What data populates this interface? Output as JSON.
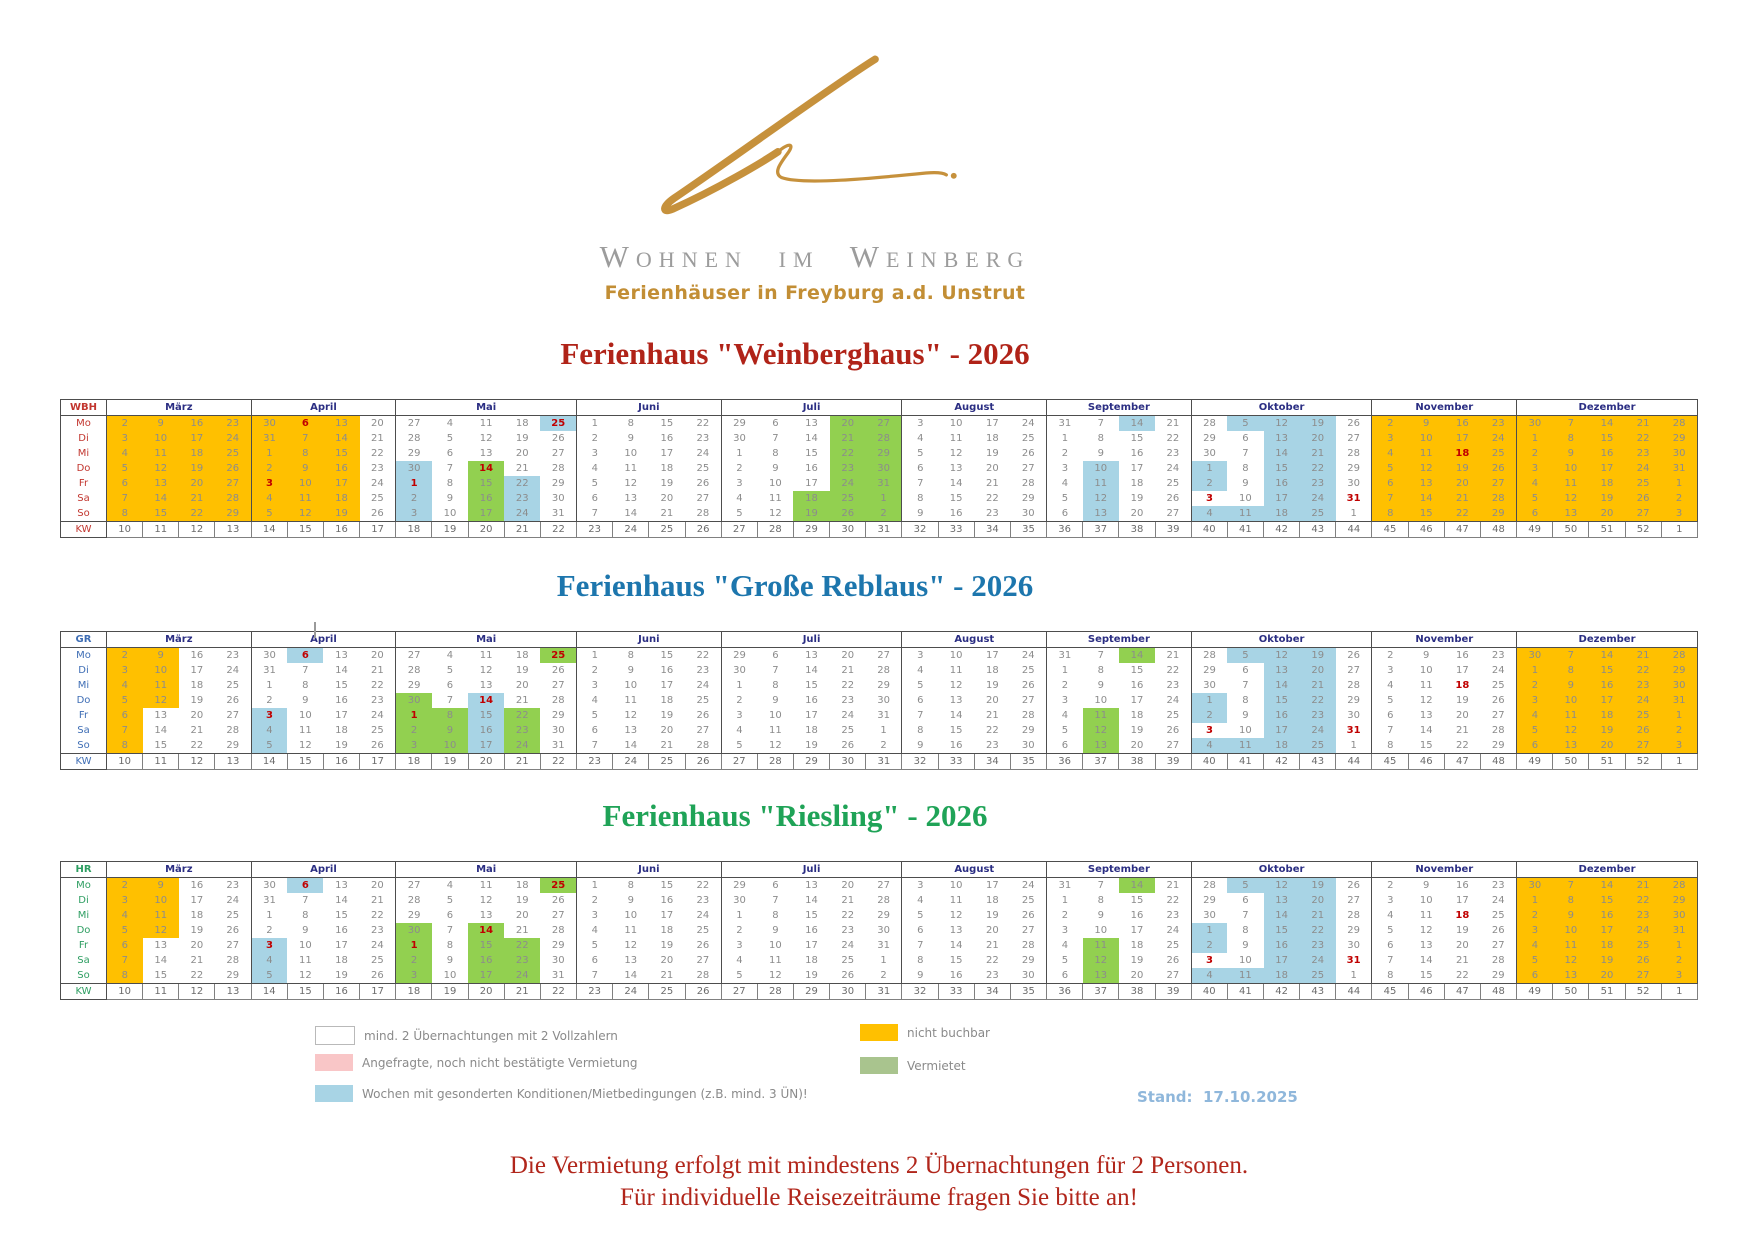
{
  "header": {
    "brand": "Wohnen im Weinberg",
    "subtitle": "Ferienhäuser in Freyburg a.d. Unstrut"
  },
  "day_labels": [
    "Mo",
    "Di",
    "Mi",
    "Do",
    "Fr",
    "Sa",
    "So"
  ],
  "kw_label": "KW",
  "months": [
    {
      "name": "März",
      "kw": [
        "10",
        "11",
        "12",
        "13"
      ],
      "days": [
        [
          "2",
          "9",
          "16",
          "23"
        ],
        [
          "3",
          "10",
          "17",
          "24"
        ],
        [
          "4",
          "11",
          "18",
          "25"
        ],
        [
          "5",
          "12",
          "19",
          "26"
        ],
        [
          "6",
          "13",
          "20",
          "27"
        ],
        [
          "7",
          "14",
          "21",
          "28"
        ],
        [
          "8",
          "15",
          "22",
          "29"
        ]
      ]
    },
    {
      "name": "April",
      "kw": [
        "14",
        "15",
        "16",
        "17"
      ],
      "days": [
        [
          "30",
          "6",
          "13",
          "20"
        ],
        [
          "31",
          "7",
          "14",
          "21"
        ],
        [
          "1",
          "8",
          "15",
          "22"
        ],
        [
          "2",
          "9",
          "16",
          "23"
        ],
        [
          "3",
          "10",
          "17",
          "24"
        ],
        [
          "4",
          "11",
          "18",
          "25"
        ],
        [
          "5",
          "12",
          "19",
          "26"
        ]
      ]
    },
    {
      "name": "Mai",
      "kw": [
        "18",
        "19",
        "20",
        "21",
        "22"
      ],
      "days": [
        [
          "27",
          "4",
          "11",
          "18",
          "25"
        ],
        [
          "28",
          "5",
          "12",
          "19",
          "26"
        ],
        [
          "29",
          "6",
          "13",
          "20",
          "27"
        ],
        [
          "30",
          "7",
          "14",
          "21",
          "28"
        ],
        [
          "1",
          "8",
          "15",
          "22",
          "29"
        ],
        [
          "2",
          "9",
          "16",
          "23",
          "30"
        ],
        [
          "3",
          "10",
          "17",
          "24",
          "31"
        ]
      ]
    },
    {
      "name": "Juni",
      "kw": [
        "23",
        "24",
        "25",
        "26"
      ],
      "days": [
        [
          "1",
          "8",
          "15",
          "22"
        ],
        [
          "2",
          "9",
          "16",
          "23"
        ],
        [
          "3",
          "10",
          "17",
          "24"
        ],
        [
          "4",
          "11",
          "18",
          "25"
        ],
        [
          "5",
          "12",
          "19",
          "26"
        ],
        [
          "6",
          "13",
          "20",
          "27"
        ],
        [
          "7",
          "14",
          "21",
          "28"
        ]
      ]
    },
    {
      "name": "Juli",
      "kw": [
        "27",
        "28",
        "29",
        "30",
        "31"
      ],
      "days": [
        [
          "29",
          "6",
          "13",
          "20",
          "27"
        ],
        [
          "30",
          "7",
          "14",
          "21",
          "28"
        ],
        [
          "1",
          "8",
          "15",
          "22",
          "29"
        ],
        [
          "2",
          "9",
          "16",
          "23",
          "30"
        ],
        [
          "3",
          "10",
          "17",
          "24",
          "31"
        ],
        [
          "4",
          "11",
          "18",
          "25",
          "1"
        ],
        [
          "5",
          "12",
          "19",
          "26",
          "2"
        ]
      ]
    },
    {
      "name": "August",
      "kw": [
        "32",
        "33",
        "34",
        "35"
      ],
      "days": [
        [
          "3",
          "10",
          "17",
          "24"
        ],
        [
          "4",
          "11",
          "18",
          "25"
        ],
        [
          "5",
          "12",
          "19",
          "26"
        ],
        [
          "6",
          "13",
          "20",
          "27"
        ],
        [
          "7",
          "14",
          "21",
          "28"
        ],
        [
          "8",
          "15",
          "22",
          "29"
        ],
        [
          "9",
          "16",
          "23",
          "30"
        ]
      ]
    },
    {
      "name": "September",
      "kw": [
        "36",
        "37",
        "38",
        "39"
      ],
      "days": [
        [
          "31",
          "7",
          "14",
          "21"
        ],
        [
          "1",
          "8",
          "15",
          "22"
        ],
        [
          "2",
          "9",
          "16",
          "23"
        ],
        [
          "3",
          "10",
          "17",
          "24"
        ],
        [
          "4",
          "11",
          "18",
          "25"
        ],
        [
          "5",
          "12",
          "19",
          "26"
        ],
        [
          "6",
          "13",
          "20",
          "27"
        ]
      ]
    },
    {
      "name": "Oktober",
      "kw": [
        "40",
        "41",
        "42",
        "43",
        "44"
      ],
      "days": [
        [
          "28",
          "5",
          "12",
          "19",
          "26"
        ],
        [
          "29",
          "6",
          "13",
          "20",
          "27"
        ],
        [
          "30",
          "7",
          "14",
          "21",
          "28"
        ],
        [
          "1",
          "8",
          "15",
          "22",
          "29"
        ],
        [
          "2",
          "9",
          "16",
          "23",
          "30"
        ],
        [
          "3",
          "10",
          "17",
          "24",
          "31"
        ],
        [
          "4",
          "11",
          "18",
          "25",
          "1"
        ]
      ]
    },
    {
      "name": "November",
      "kw": [
        "45",
        "46",
        "47",
        "48"
      ],
      "days": [
        [
          "2",
          "9",
          "16",
          "23"
        ],
        [
          "3",
          "10",
          "17",
          "24"
        ],
        [
          "4",
          "11",
          "18",
          "25"
        ],
        [
          "5",
          "12",
          "19",
          "26"
        ],
        [
          "6",
          "13",
          "20",
          "27"
        ],
        [
          "7",
          "14",
          "21",
          "28"
        ],
        [
          "8",
          "15",
          "22",
          "29"
        ]
      ]
    },
    {
      "name": "Dezember",
      "kw": [
        "49",
        "50",
        "51",
        "52",
        "1"
      ],
      "days": [
        [
          "30",
          "7",
          "14",
          "21",
          "28"
        ],
        [
          "1",
          "8",
          "15",
          "22",
          "29"
        ],
        [
          "2",
          "9",
          "16",
          "23",
          "30"
        ],
        [
          "3",
          "10",
          "17",
          "24",
          "31"
        ],
        [
          "4",
          "11",
          "18",
          "25",
          "1"
        ],
        [
          "5",
          "12",
          "19",
          "26",
          "2"
        ],
        [
          "6",
          "13",
          "20",
          "27",
          "3"
        ]
      ]
    }
  ],
  "holidays": [
    "1-0-1",
    "1-4-0",
    "2-4-0",
    "2-3-2",
    "2-0-4",
    "7-5-0",
    "7-5-4",
    "8-2-2"
  ],
  "calendars": [
    {
      "code": "WBH",
      "title": "Ferienhaus \"Weinberghaus\" - 2026",
      "title_color": "#b02318",
      "label_color": "#c2362f",
      "colors": [
        [
          "oooo",
          "oooo",
          "oooo",
          "oooo",
          "oooo",
          "oooo",
          "oooo"
        ],
        [
          "ooow",
          "ooow",
          "ooow",
          "ooow",
          "ooow",
          "ooow",
          "ooow"
        ],
        [
          "wwwwb",
          "wwwww",
          "wwwww",
          "bwgww",
          "bwgbw",
          "bwgbw",
          "bwgbw"
        ],
        [
          "wwww",
          "wwww",
          "wwww",
          "wwww",
          "wwww",
          "wwww",
          "wwww"
        ],
        [
          "wwwgg",
          "wwwgg",
          "wwwgg",
          "wwwgg",
          "wwwgg",
          "wwggg",
          "wwggg"
        ],
        [
          "wwww",
          "wwww",
          "wwww",
          "wwww",
          "wwww",
          "wwww",
          "wwww"
        ],
        [
          "wwbw",
          "wwww",
          "wwww",
          "wbww",
          "wbww",
          "wbww",
          "wbww"
        ],
        [
          "wbbbw",
          "wwbbw",
          "wwbbw",
          "bwbbw",
          "bwbbw",
          "wwbbw",
          "bbbbw"
        ],
        [
          "oooo",
          "oooo",
          "oooo",
          "oooo",
          "oooo",
          "oooo",
          "oooo"
        ],
        [
          "ooooo",
          "ooooo",
          "ooooo",
          "ooooo",
          "ooooo",
          "ooooo",
          "ooooo"
        ]
      ]
    },
    {
      "code": "GR",
      "title": "Ferienhaus \"Große Reblaus\" - 2026",
      "title_color": "#1d76ad",
      "label_color": "#3f6eb5",
      "colors": [
        [
          "ooww",
          "ooww",
          "ooww",
          "ooww",
          "owww",
          "owww",
          "owww"
        ],
        [
          "wbww",
          "wwww",
          "wwww",
          "wwww",
          "bwww",
          "bwww",
          "bwww"
        ],
        [
          "wwwwg",
          "wwwww",
          "wwwww",
          "gwbww",
          "ggbgw",
          "ggbgw",
          "ggbgw"
        ],
        [
          "wwww",
          "wwww",
          "wwww",
          "wwww",
          "wwww",
          "wwww",
          "wwww"
        ],
        [
          "wwwww",
          "wwwww",
          "wwwww",
          "wwwww",
          "wwwww",
          "wwwww",
          "wwwww"
        ],
        [
          "wwww",
          "wwww",
          "wwww",
          "wwww",
          "wwww",
          "wwww",
          "wwww"
        ],
        [
          "wwgw",
          "wwww",
          "wwww",
          "wwww",
          "wgww",
          "wgww",
          "wgww"
        ],
        [
          "wbbbw",
          "wwbbw",
          "wwbbw",
          "bwbbw",
          "bwbbw",
          "wwbbw",
          "bbbbw"
        ],
        [
          "wwww",
          "wwww",
          "wwww",
          "wwww",
          "wwww",
          "wwww",
          "wwww"
        ],
        [
          "ooooo",
          "ooooo",
          "ooooo",
          "ooooo",
          "ooooo",
          "ooooo",
          "ooooo"
        ]
      ]
    },
    {
      "code": "HR",
      "title": "Ferienhaus \"Riesling\" - 2026",
      "title_color": "#1fa357",
      "label_color": "#2e9e62",
      "colors": [
        [
          "ooww",
          "ooww",
          "ooww",
          "ooww",
          "owww",
          "owww",
          "owww"
        ],
        [
          "wbww",
          "wwww",
          "wwww",
          "wwww",
          "bwww",
          "bwww",
          "bwww"
        ],
        [
          "wwwwg",
          "wwwww",
          "wwwww",
          "gwgww",
          "gwggw",
          "gwggw",
          "gwggw"
        ],
        [
          "wwww",
          "wwww",
          "wwww",
          "wwww",
          "wwww",
          "wwww",
          "wwww"
        ],
        [
          "wwwww",
          "wwwww",
          "wwwww",
          "wwwww",
          "wwwww",
          "wwwww",
          "wwwww"
        ],
        [
          "wwww",
          "wwww",
          "wwww",
          "wwww",
          "wwww",
          "wwww",
          "wwww"
        ],
        [
          "wwgw",
          "wwww",
          "wwww",
          "wwww",
          "wgww",
          "wgww",
          "wgww"
        ],
        [
          "wbbbw",
          "wwbbw",
          "wwbbw",
          "bwbbw",
          "bwbbw",
          "wwbbw",
          "bbbbw"
        ],
        [
          "wwww",
          "wwww",
          "wwww",
          "wwww",
          "wwww",
          "wwww",
          "wwww"
        ],
        [
          "ooooo",
          "ooooo",
          "ooooo",
          "ooooo",
          "ooooo",
          "ooooo",
          "ooooo"
        ]
      ]
    }
  ],
  "legend": {
    "white_label": "mind. 2 Übernachtungen mit 2 Vollzahlern",
    "pink_label": "Angefragte, noch nicht bestätigte Vermietung",
    "blue_label": "Wochen mit gesonderten Konditionen/Mietbedingungen (z.B. mind. 3 ÜN)!",
    "orange_label": "nicht buchbar",
    "green_label": "Vermietet",
    "stand_text": "Stand:  17.10.2025"
  },
  "footer": {
    "line1": "Die Vermietung erfolgt mit mindestens 2 Übernachtungen für 2 Personen.",
    "line2": "Für individuelle Reisezeiträume fragen Sie bitte an!"
  },
  "colors": {
    "not_bookable_orange": "#ffc000",
    "special_conditions_blue": "#a8d4e5",
    "rented_green": "#92d050",
    "legend_rented_green": "#a9c48e",
    "inquiry_pink": "#f9c6c7",
    "holiday_red": "#c00000",
    "date_gray": "#8c8c8c",
    "month_header_navy": "#2b2e83",
    "brand_gold": "#c28e35",
    "brand_gray": "#9c9c9c",
    "stand_blue": "#8fb7db",
    "footer_red": "#b1261b"
  }
}
